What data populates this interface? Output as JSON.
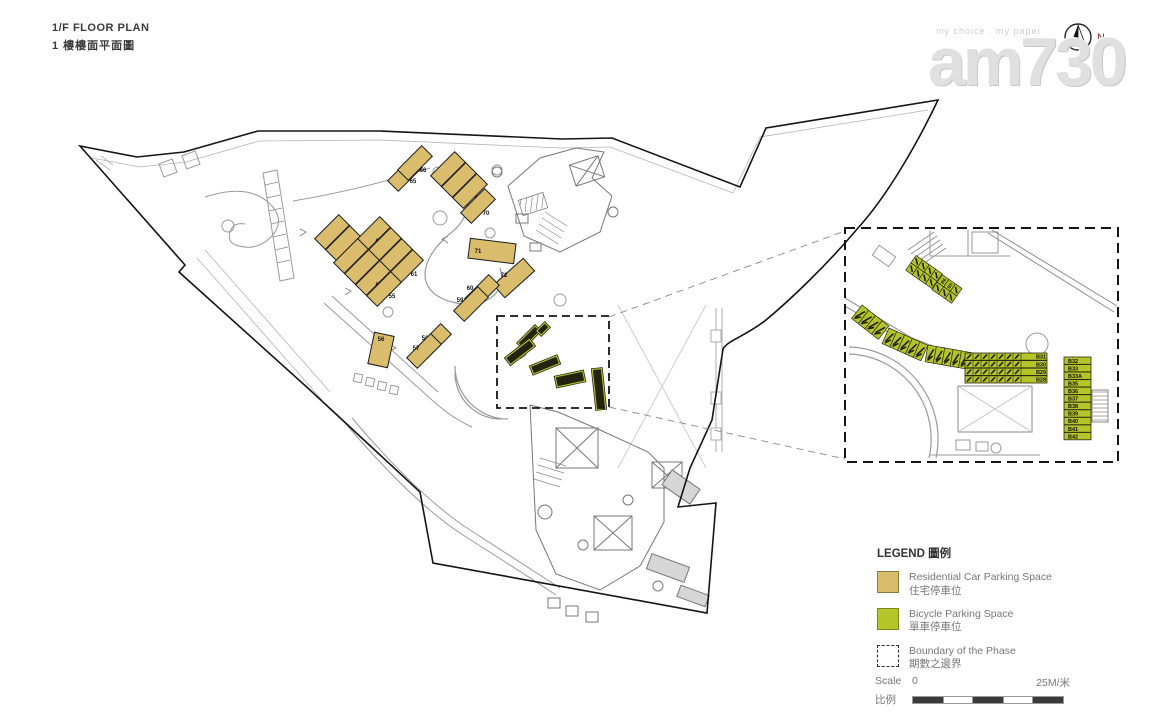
{
  "title": {
    "line1": "1/F FLOOR PLAN",
    "line2": "1 樓樓面平面圖"
  },
  "logo": {
    "tagline": "my choice . my paper",
    "name": "am730",
    "north_label": "N"
  },
  "legend": {
    "heading": "LEGEND 圖例",
    "items": [
      {
        "en": "Residential Car Parking Space",
        "zh": "住宅停車位"
      },
      {
        "en": "Bicycle Parking Space",
        "zh": "單車停車位"
      },
      {
        "en": "Boundary of the Phase",
        "zh": "期數之邊界"
      }
    ]
  },
  "scalebar": {
    "label_en": "Scale",
    "label_zh": "比例",
    "start": "0",
    "end": "25M/米"
  },
  "colors": {
    "car": "#d9bd6d",
    "bike": "#b3c529",
    "bike_dark": "#23230f",
    "line": "#9a9a9a",
    "line_dark": "#6e6e6e",
    "boundary": "#141414",
    "north_n": "#8a2a2a"
  },
  "plan": {
    "car_spaces": [
      {
        "label": "50",
        "cx": 332,
        "cy": 232,
        "w": 34,
        "h": 15,
        "r": -45,
        "lx": 8,
        "ly": 9
      },
      {
        "label": "51",
        "cx": 343,
        "cy": 243,
        "w": 34,
        "h": 15,
        "r": -45,
        "lx": 8,
        "ly": 9
      },
      {
        "label": "63A",
        "cx": 373,
        "cy": 234,
        "w": 34,
        "h": 15,
        "r": -45,
        "lx": 8,
        "ly": 9
      },
      {
        "label": "63",
        "cx": 384,
        "cy": 245,
        "w": 34,
        "h": 15,
        "r": -45,
        "lx": 8,
        "ly": 9
      },
      {
        "label": "62",
        "cx": 395,
        "cy": 256,
        "w": 34,
        "h": 15,
        "r": -45,
        "lx": 8,
        "ly": 9
      },
      {
        "label": "61",
        "cx": 406,
        "cy": 267,
        "w": 34,
        "h": 15,
        "r": -45,
        "lx": 8,
        "ly": 9
      },
      {
        "label": "52",
        "cx": 351,
        "cy": 256,
        "w": 34,
        "h": 15,
        "r": -45,
        "lx": 8,
        "ly": 9
      },
      {
        "label": "53",
        "cx": 362,
        "cy": 267,
        "w": 34,
        "h": 15,
        "r": -45,
        "lx": 8,
        "ly": 9
      },
      {
        "label": "53A",
        "cx": 373,
        "cy": 278,
        "w": 34,
        "h": 15,
        "r": -45,
        "lx": 8,
        "ly": 9
      },
      {
        "label": "55",
        "cx": 384,
        "cy": 289,
        "w": 34,
        "h": 15,
        "r": -45,
        "lx": 8,
        "ly": 9
      },
      {
        "label": "65",
        "cx": 405,
        "cy": 174,
        "w": 34,
        "h": 15,
        "r": -45,
        "lx": 8,
        "ly": 9
      },
      {
        "label": "66",
        "cx": 415,
        "cy": 163,
        "w": 34,
        "h": 15,
        "r": -45,
        "lx": 8,
        "ly": 9
      },
      {
        "label": "67",
        "cx": 448,
        "cy": 169,
        "w": 34,
        "h": 15,
        "r": -45,
        "lx": 8,
        "ly": 9
      },
      {
        "label": "68",
        "cx": 459,
        "cy": 180,
        "w": 34,
        "h": 15,
        "r": -45,
        "lx": 8,
        "ly": 9
      },
      {
        "label": "69",
        "cx": 470,
        "cy": 191,
        "w": 34,
        "h": 15,
        "r": -45,
        "lx": 8,
        "ly": 9
      },
      {
        "label": "70",
        "cx": 478,
        "cy": 206,
        "w": 34,
        "h": 15,
        "r": -45,
        "lx": 8,
        "ly": 9
      },
      {
        "label": "71",
        "cx": 492,
        "cy": 251,
        "w": 46,
        "h": 20,
        "r": 7,
        "lx": -14,
        "ly": 2
      },
      {
        "label": "72",
        "cx": 514,
        "cy": 278,
        "w": 40,
        "h": 17,
        "r": -42,
        "lx": -10,
        "ly": -1
      },
      {
        "label": "60",
        "cx": 482,
        "cy": 292,
        "w": 34,
        "h": 15,
        "r": -45,
        "lx": -12,
        "ly": -2
      },
      {
        "label": "59",
        "cx": 471,
        "cy": 304,
        "w": 34,
        "h": 15,
        "r": -45,
        "lx": -11,
        "ly": -2
      },
      {
        "label": "58",
        "cx": 434,
        "cy": 341,
        "w": 34,
        "h": 15,
        "r": -45,
        "lx": -9,
        "ly": -1
      },
      {
        "label": "57",
        "cx": 424,
        "cy": 351,
        "w": 34,
        "h": 15,
        "r": -45,
        "lx": -8,
        "ly": -1
      },
      {
        "label": "56",
        "cx": 381,
        "cy": 350,
        "w": 20,
        "h": 32,
        "r": 12,
        "lx": 0,
        "ly": -9
      }
    ],
    "bike_strips": [
      {
        "cx": 529,
        "cy": 337,
        "w": 26,
        "h": 9,
        "r": -45
      },
      {
        "cx": 543,
        "cy": 329,
        "w": 13,
        "h": 8,
        "r": -45
      },
      {
        "cx": 520,
        "cy": 352,
        "w": 32,
        "h": 10,
        "r": -38
      },
      {
        "cx": 545,
        "cy": 365,
        "w": 30,
        "h": 10,
        "r": -22
      },
      {
        "cx": 570,
        "cy": 379,
        "w": 30,
        "h": 12,
        "r": -12
      },
      {
        "cx": 599,
        "cy": 389,
        "w": 11,
        "h": 42,
        "r": -6
      }
    ],
    "phase_box": {
      "x": 497,
      "y": 316,
      "w": 112,
      "h": 92
    }
  },
  "inset": {
    "box": {
      "x": 845,
      "y": 228,
      "w": 273,
      "h": 234
    },
    "grids": [
      {
        "x": 924,
        "y": 272,
        "r": -55,
        "cols": 2,
        "rows": 4,
        "cw": 9,
        "ch": 8,
        "labels": []
      },
      {
        "x": 947,
        "y": 289,
        "r": -55,
        "cols": 2,
        "rows": 3,
        "cw": 9,
        "ch": 8,
        "labels": [
          "B6",
          "B5"
        ]
      }
    ],
    "strip_segments": [
      {
        "x": 862,
        "y": 305,
        "r": 38,
        "n": 4,
        "cw": 8.5,
        "cl": 17
      },
      {
        "x": 889,
        "y": 328,
        "r": 24,
        "n": 5,
        "cw": 8.5,
        "cl": 17
      },
      {
        "x": 928,
        "y": 345,
        "r": 10,
        "n": 6,
        "cw": 8.5,
        "cl": 17
      }
    ],
    "rows_block": {
      "x": 965,
      "y": 353,
      "w": 82,
      "h": 7.2,
      "pitch": 7.6
    },
    "row_labels": [
      "B31",
      "B30",
      "B29",
      "B28"
    ],
    "column_block": {
      "x": 1064,
      "y": 357,
      "w": 27,
      "h": 7.3,
      "pitch": 7.55
    },
    "column_labels": [
      "B32",
      "B33",
      "B33A",
      "B35",
      "B36",
      "B37",
      "B38",
      "B39",
      "B40",
      "B41",
      "B42"
    ]
  }
}
